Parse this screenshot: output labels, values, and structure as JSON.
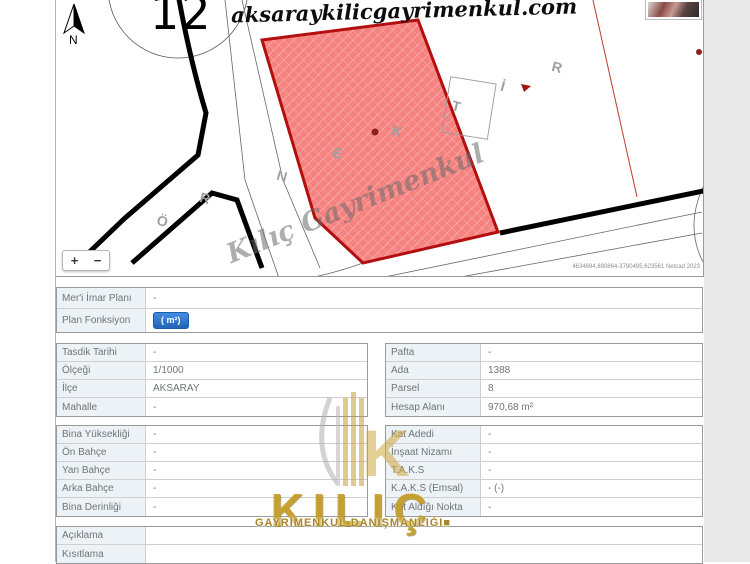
{
  "site": {
    "watermark_top": "aksaraykilicgayrimenkul.com",
    "watermark_map": "Kılıç Gayrimenkul",
    "brand_name": "KILIÇ",
    "brand_subtitle": "GAYRİMENKUL DANIŞMANLIĞI",
    "brand_square": "■"
  },
  "colors": {
    "accent_blue": "#2e7bcf",
    "brand_gold": "#c5a02b",
    "parcel_fill": "#f5827f",
    "parcel_border": "#b40f0f",
    "label_cell_bg": "#edf2f7"
  },
  "map": {
    "block_number": "12",
    "sample_word_letters": [
      {
        "ch": "Ö",
        "x": 101,
        "y": 213
      },
      {
        "ch": "R",
        "x": 144,
        "y": 190
      },
      {
        "ch": "N",
        "x": 221,
        "y": 168
      },
      {
        "ch": "E",
        "x": 277,
        "y": 145
      },
      {
        "ch": "K",
        "x": 336,
        "y": 123
      },
      {
        "ch": "T",
        "x": 396,
        "y": 98
      },
      {
        "ch": "İ",
        "x": 445,
        "y": 78
      },
      {
        "ch": "R",
        "x": 496,
        "y": 59
      }
    ],
    "north_label": "N",
    "coords_text": "4634694,880864-3790495,623561 Netcad 2023",
    "zoom_in": "+",
    "zoom_out": "−"
  },
  "tables": {
    "plan": [
      {
        "label": "Mer'i İmar Planı",
        "value": "-"
      },
      {
        "label": "Plan Fonksiyon",
        "value": "",
        "button": "( m²)"
      }
    ],
    "left1": [
      {
        "label": "Tasdik Tarihi",
        "value": "-"
      },
      {
        "label": "Ölçeği",
        "value": "1/1000"
      },
      {
        "label": "İlçe",
        "value": "AKSARAY"
      },
      {
        "label": "Mahalle",
        "value": "-"
      }
    ],
    "right1": [
      {
        "label": "Pafta",
        "value": "-"
      },
      {
        "label": "Ada",
        "value": "1388"
      },
      {
        "label": "Parsel",
        "value": "8"
      },
      {
        "label": "Hesap Alanı",
        "value": "970,68 m²"
      }
    ],
    "left2": [
      {
        "label": "Bina Yüksekliği",
        "value": "-"
      },
      {
        "label": "Ön Bahçe",
        "value": "-"
      },
      {
        "label": "Yan Bahçe",
        "value": "-"
      },
      {
        "label": "Arka Bahçe",
        "value": "-"
      },
      {
        "label": "Bina Derinliği",
        "value": "-"
      }
    ],
    "right2": [
      {
        "label": "Kat Adedi",
        "value": "-"
      },
      {
        "label": "İnşaat Nizamı",
        "value": "-"
      },
      {
        "label": "T.A.K.S",
        "value": "-"
      },
      {
        "label": "K.A.K.S (Emsal)",
        "value": "- (-)"
      },
      {
        "label": "Kot Aldığı Nokta",
        "value": "-"
      }
    ],
    "bottom": [
      {
        "label": "Açıklama",
        "value": ""
      },
      {
        "label": "Kısıtlama",
        "value": ""
      }
    ]
  }
}
